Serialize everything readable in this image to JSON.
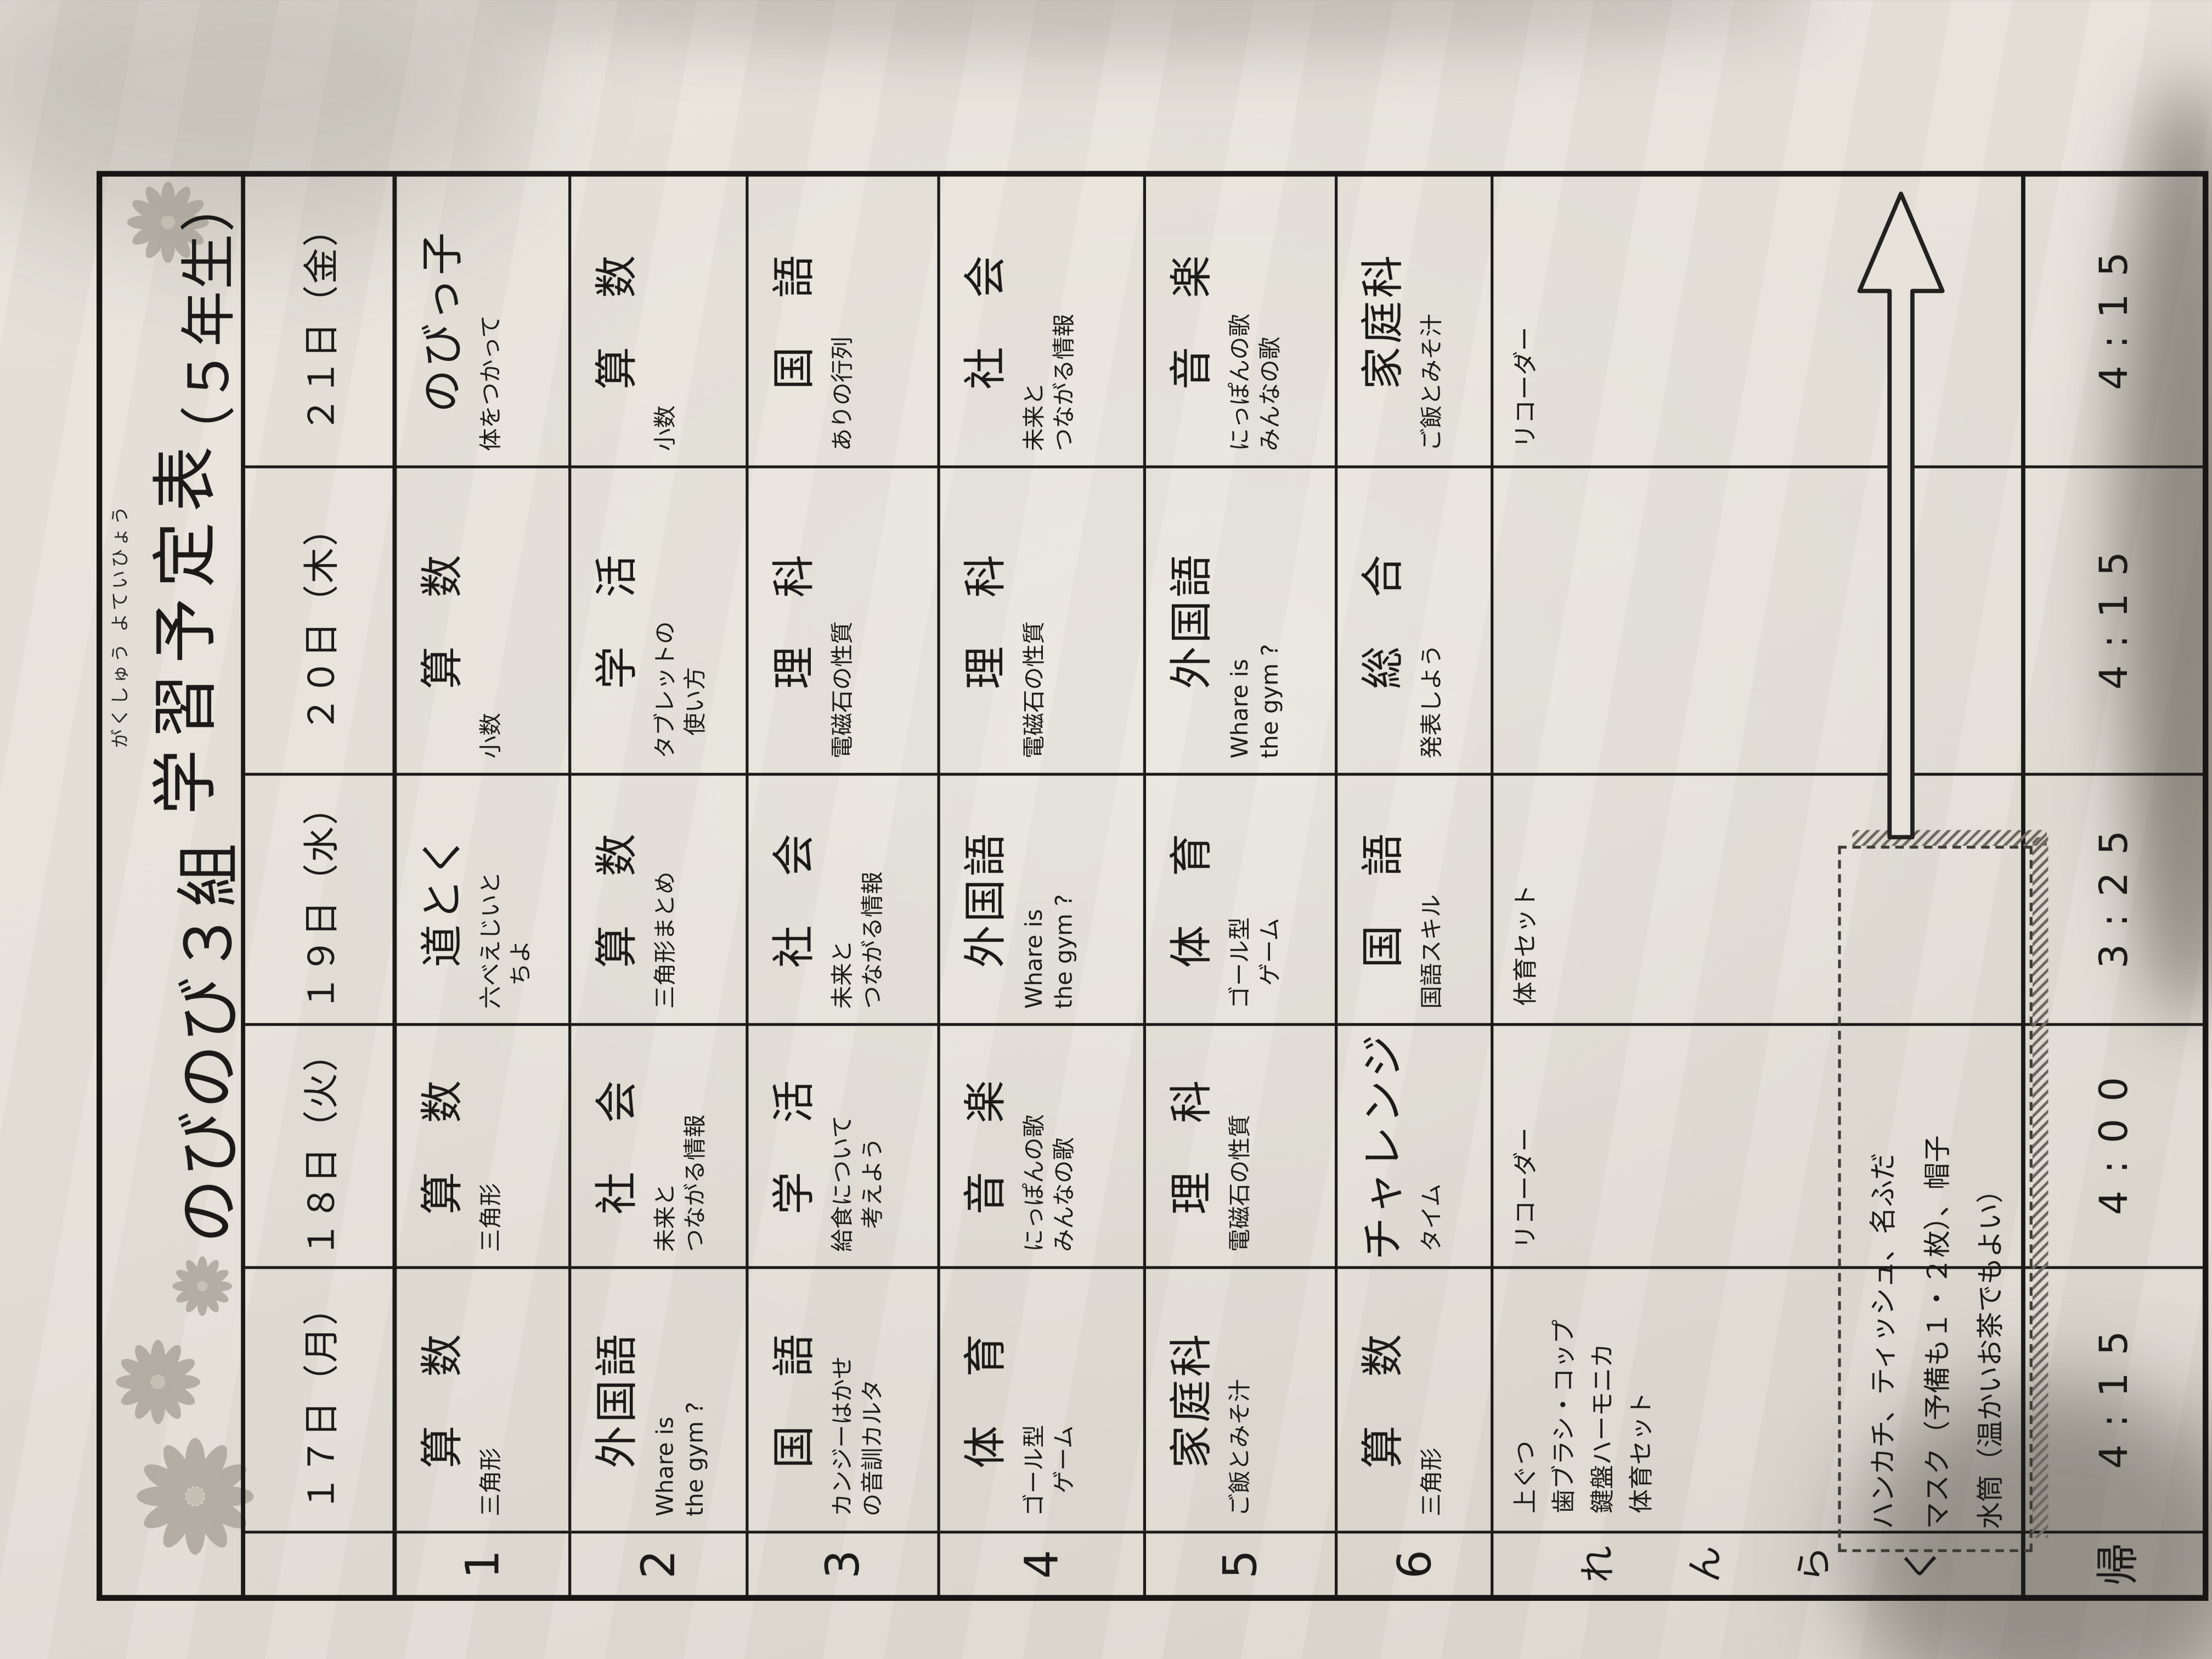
{
  "page": {
    "background_color": "#8f897e",
    "paper_color": "#e6e2da",
    "ink_color": "#1b1a18"
  },
  "icons": {
    "flower": "starburst-flower-icon",
    "arrow": "week-long-right-arrow-icon"
  },
  "title": {
    "furigana": "がくしゅう よていひょう",
    "class_name": "のびのび３組",
    "main": "学習予定表",
    "grade": "（５年生）"
  },
  "table": {
    "period_labels": [
      "1",
      "2",
      "3",
      "4",
      "5",
      "6"
    ],
    "renraku_label_chars": [
      "れ",
      "ん",
      "ら",
      "く"
    ],
    "kaeri_label": "帰",
    "days": [
      {
        "header": "１７日（月）",
        "periods": [
          {
            "subject": "算　数",
            "topic": [
              "三角形"
            ]
          },
          {
            "subject": "外国語",
            "topic": [
              "Whare is",
              "the gym ?"
            ]
          },
          {
            "subject": "国　語",
            "topic": [
              "カンジーはかせ",
              "の音訓カルタ"
            ]
          },
          {
            "subject": "体　育",
            "topic": [
              "ゴール型",
              "　ゲーム"
            ]
          },
          {
            "subject": "家庭科",
            "topic": [
              "ご飯とみそ汁"
            ]
          },
          {
            "subject": "算　数",
            "topic": [
              "三角形"
            ]
          }
        ],
        "renraku": [
          "上ぐつ",
          "歯ブラシ・コップ",
          "鍵盤ハーモニカ",
          "体育セット"
        ],
        "dismissal": "4:15"
      },
      {
        "header": "１８日（火）",
        "periods": [
          {
            "subject": "算　数",
            "topic": [
              "三角形"
            ]
          },
          {
            "subject": "社　会",
            "topic": [
              "未来と",
              "つながる情報"
            ]
          },
          {
            "subject": "学　活",
            "topic": [
              "給食について",
              "　考えよう"
            ]
          },
          {
            "subject": "音　楽",
            "topic": [
              "にっぽんの歌",
              "みんなの歌"
            ]
          },
          {
            "subject": "理　科",
            "topic": [
              "電磁石の性質"
            ]
          },
          {
            "subject": "チャレンジ",
            "topic": [
              "タイム"
            ]
          }
        ],
        "renraku": [
          "リコーダー"
        ],
        "dismissal": "4:00"
      },
      {
        "header": "１９日（水）",
        "periods": [
          {
            "subject": "道とく",
            "topic": [
              "六べえじいと",
              "　ちよ"
            ]
          },
          {
            "subject": "算　数",
            "topic": [
              "三角形まとめ"
            ]
          },
          {
            "subject": "社　会",
            "topic": [
              "未来と",
              "つながる情報"
            ]
          },
          {
            "subject": "外国語",
            "topic": [
              "Whare is",
              "the gym ?"
            ]
          },
          {
            "subject": "体　育",
            "topic": [
              "ゴール型",
              "　ゲーム"
            ]
          },
          {
            "subject": "国　語",
            "topic": [
              "国語スキル"
            ]
          }
        ],
        "renraku": [
          "体育セット"
        ],
        "dismissal": "3:25"
      },
      {
        "header": "２０日（木）",
        "periods": [
          {
            "subject": "算　数",
            "topic": [
              "小数"
            ]
          },
          {
            "subject": "学　活",
            "topic": [
              "タブレットの",
              "　使い方"
            ]
          },
          {
            "subject": "理　科",
            "topic": [
              "電磁石の性質"
            ]
          },
          {
            "subject": "理　科",
            "topic": [
              "電磁石の性質"
            ]
          },
          {
            "subject": "外国語",
            "topic": [
              "Whare is",
              "the gym ?"
            ]
          },
          {
            "subject": "総　合",
            "topic": [
              "発表しよう"
            ]
          }
        ],
        "renraku": [],
        "dismissal": "4:15"
      },
      {
        "header": "２１日（金）",
        "periods": [
          {
            "subject": "のびっ子",
            "topic": [
              "体をつかって"
            ]
          },
          {
            "subject": "算　数",
            "topic": [
              "小数"
            ]
          },
          {
            "subject": "国　語",
            "topic": [
              "ありの行列"
            ]
          },
          {
            "subject": "社　会",
            "topic": [
              "未来と",
              "つながる情報"
            ]
          },
          {
            "subject": "音　楽",
            "topic": [
              "にっぽんの歌",
              "みんなの歌"
            ]
          },
          {
            "subject": "家庭科",
            "topic": [
              "ご飯とみそ汁"
            ]
          }
        ],
        "renraku": [
          "リコーダー"
        ],
        "dismissal": "4:15"
      }
    ]
  },
  "note_box": {
    "lines": [
      "ハンカチ、ティッシュ、名ふだ",
      "マスク（予備も１・２枚）、帽子",
      "水筒（温かいお茶でもよい）"
    ]
  }
}
